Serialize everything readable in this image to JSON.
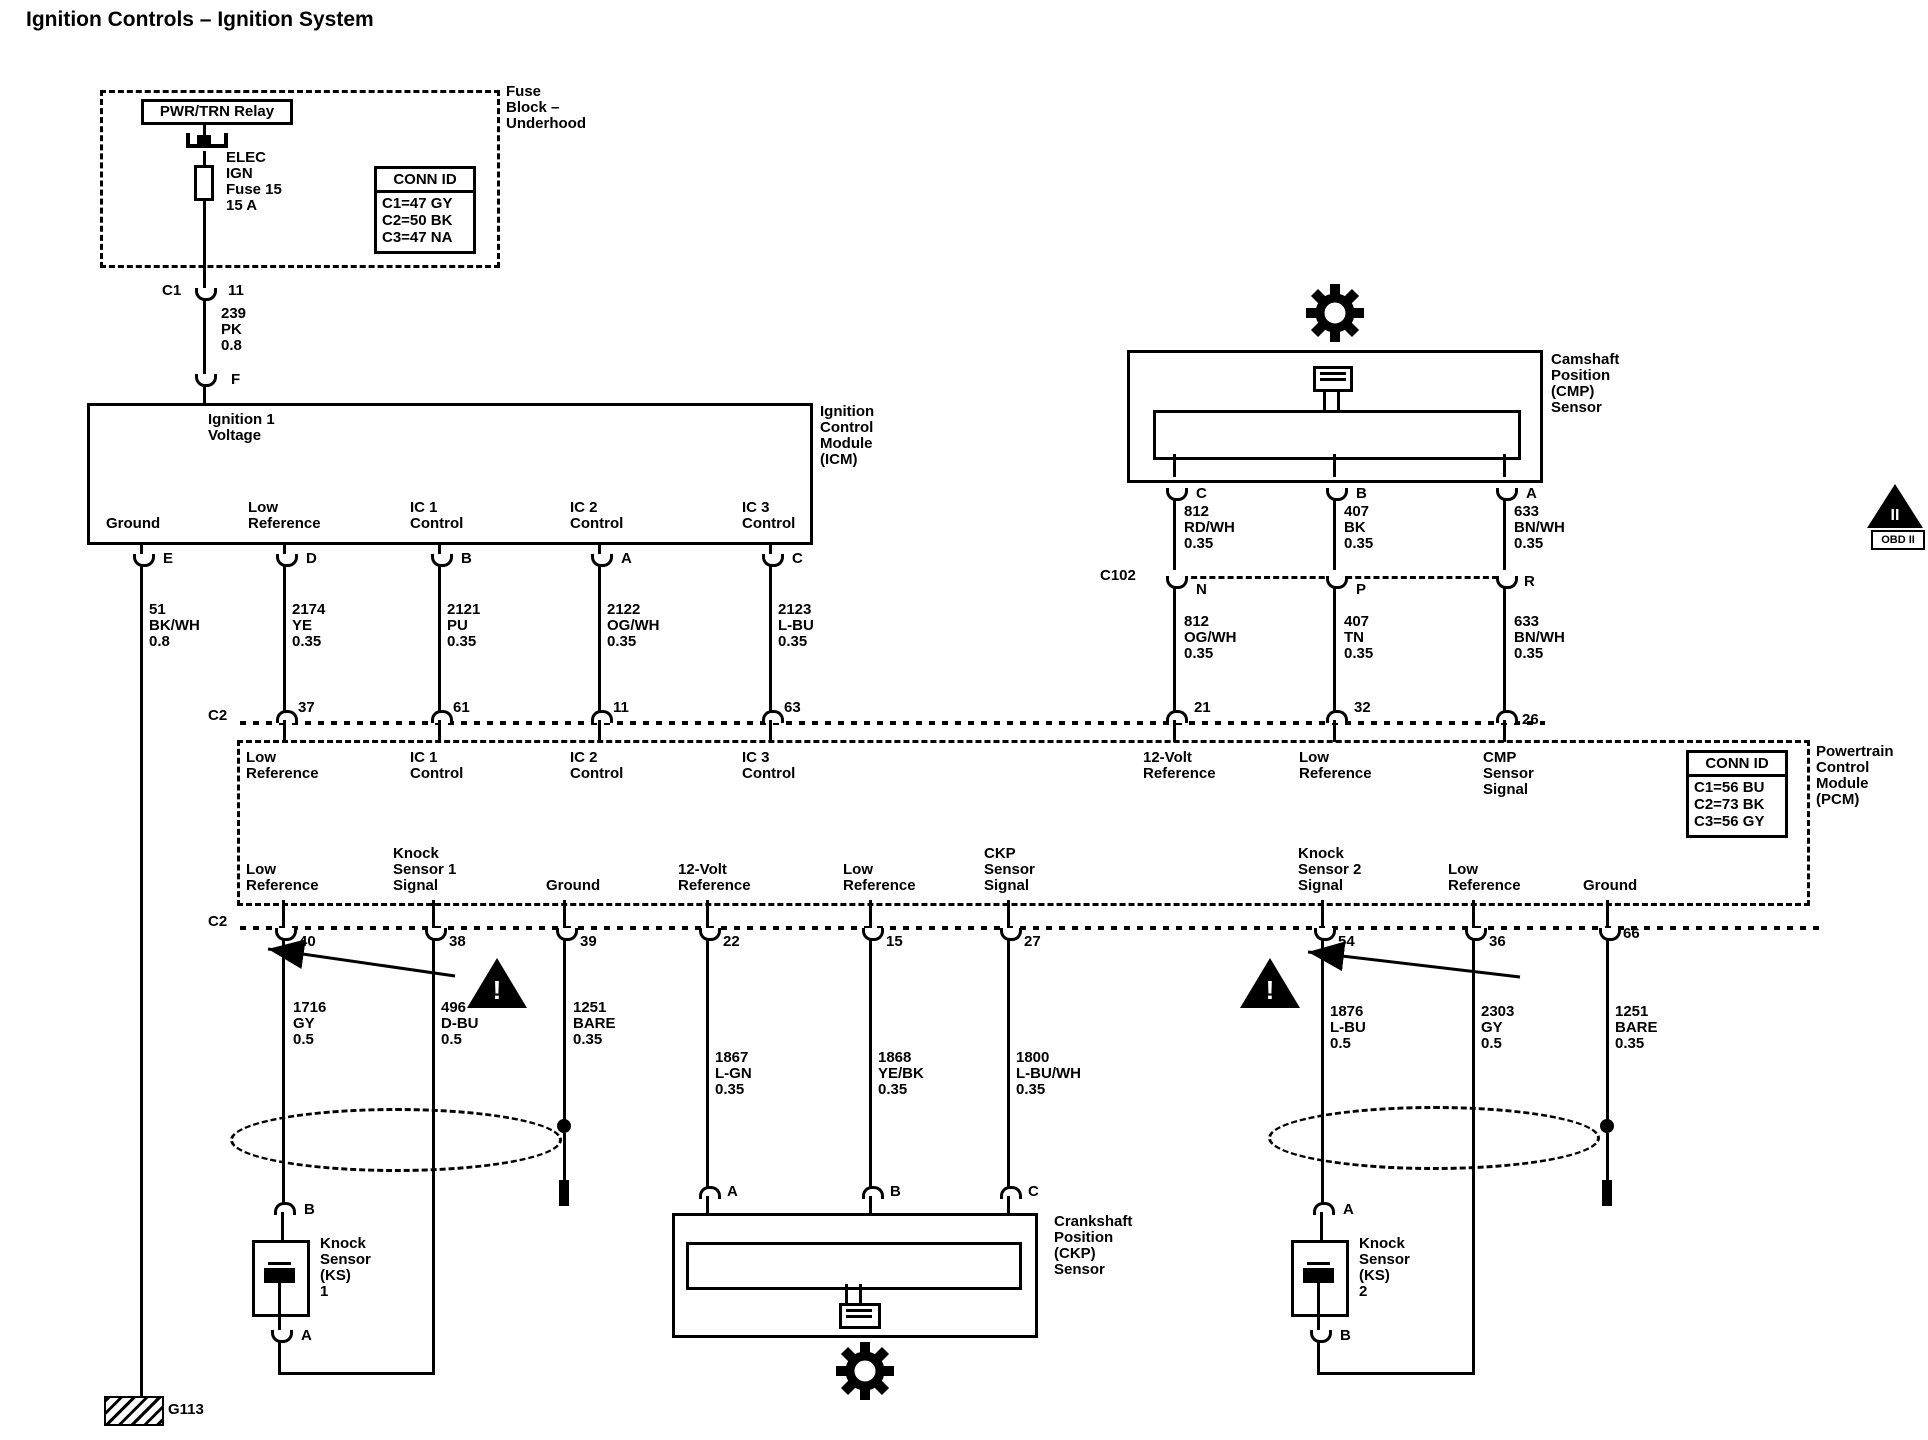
{
  "title": "Ignition Controls – Ignition System",
  "fuse_block": {
    "name": [
      "Fuse",
      "Block –",
      "Underhood"
    ],
    "relay_label": "PWR/TRN Relay",
    "fuse_label": [
      "ELEC",
      "IGN",
      "Fuse 15",
      "15 A"
    ],
    "conn_id": {
      "title": "CONN ID",
      "rows": [
        "C1=47 GY",
        "C2=50 BK",
        "C3=47 NA"
      ]
    },
    "connector": {
      "name": "C1",
      "pin": "11"
    },
    "wire": [
      "239",
      "PK",
      "0.8"
    ],
    "icm_pin": "F"
  },
  "icm": {
    "input_label": [
      "Ignition 1",
      "Voltage"
    ],
    "name": [
      "Ignition",
      "Control",
      "Module",
      "(ICM)"
    ],
    "functions": [
      [
        "Ground"
      ],
      [
        "Low",
        "Reference"
      ],
      [
        "IC 1",
        "Control"
      ],
      [
        "IC 2",
        "Control"
      ],
      [
        "IC 3",
        "Control"
      ]
    ],
    "pins": [
      "E",
      "D",
      "B",
      "A",
      "C"
    ],
    "wires": [
      [
        "51",
        "BK/WH",
        "0.8"
      ],
      [
        "2174",
        "YE",
        "0.35"
      ],
      [
        "2121",
        "PU",
        "0.35"
      ],
      [
        "2122",
        "OG/WH",
        "0.35"
      ],
      [
        "2123",
        "L-BU",
        "0.35"
      ]
    ]
  },
  "pcm": {
    "name": [
      "Powertrain",
      "Control",
      "Module",
      "(PCM)"
    ],
    "conn_id": {
      "title": "CONN ID",
      "rows": [
        "C1=56 BU",
        "C2=73 BK",
        "C3=56 GY"
      ]
    },
    "top_connector": "C2",
    "top_pins": [
      "37",
      "61",
      "11",
      "63",
      "21",
      "32",
      "26"
    ],
    "top_functions": [
      [
        "Low",
        "Reference"
      ],
      [
        "IC 1",
        "Control"
      ],
      [
        "IC 2",
        "Control"
      ],
      [
        "IC 3",
        "Control"
      ],
      [
        "12-Volt",
        "Reference"
      ],
      [
        "Low",
        "Reference"
      ],
      [
        "CMP",
        "Sensor",
        "Signal"
      ]
    ],
    "bottom_connector": "C2",
    "bottom_pins": [
      "40",
      "38",
      "39",
      "22",
      "15",
      "27",
      "54",
      "36",
      "66"
    ],
    "bottom_functions": [
      [
        "Low",
        "Reference"
      ],
      [
        "Knock",
        "Sensor 1",
        "Signal"
      ],
      [
        "Ground"
      ],
      [
        "12-Volt",
        "Reference"
      ],
      [
        "Low",
        "Reference"
      ],
      [
        "CKP",
        "Sensor",
        "Signal"
      ],
      [
        "Knock",
        "Sensor 2",
        "Signal"
      ],
      [
        "Low",
        "Reference"
      ],
      [
        "Ground"
      ]
    ]
  },
  "cmp_sensor": {
    "name": [
      "Camshaft",
      "Position",
      "(CMP)",
      "Sensor"
    ],
    "pins": [
      "C",
      "B",
      "A"
    ],
    "wires_upper": [
      [
        "812",
        "RD/WH",
        "0.35"
      ],
      [
        "407",
        "BK",
        "0.35"
      ],
      [
        "633",
        "BN/WH",
        "0.35"
      ]
    ],
    "connector": {
      "name": "C102",
      "pins": [
        "N",
        "P",
        "R"
      ]
    },
    "wires_lower": [
      [
        "812",
        "OG/WH",
        "0.35"
      ],
      [
        "407",
        "TN",
        "0.35"
      ],
      [
        "633",
        "BN/WH",
        "0.35"
      ]
    ]
  },
  "ckp_sensor": {
    "name": [
      "Crankshaft",
      "Position",
      "(CKP)",
      "Sensor"
    ],
    "pins": [
      "A",
      "B",
      "C"
    ]
  },
  "knock_sensor_1": {
    "name": [
      "Knock",
      "Sensor",
      "(KS)",
      "1"
    ],
    "top_pin": "B",
    "bottom_pin": "A"
  },
  "knock_sensor_2": {
    "name": [
      "Knock",
      "Sensor",
      "(KS)",
      "2"
    ],
    "top_pin": "A",
    "bottom_pin": "B"
  },
  "harness_wires": [
    [
      "1716",
      "GY",
      "0.5"
    ],
    [
      "496",
      "D-BU",
      "0.5"
    ],
    [
      "1251",
      "BARE",
      "0.35"
    ],
    [
      "1867",
      "L-GN",
      "0.35"
    ],
    [
      "1868",
      "YE/BK",
      "0.35"
    ],
    [
      "1800",
      "L-BU/WH",
      "0.35"
    ],
    [
      "1876",
      "L-BU",
      "0.5"
    ],
    [
      "2303",
      "GY",
      "0.5"
    ],
    [
      "1251",
      "BARE",
      "0.35"
    ]
  ],
  "ground_point": "G113",
  "obd_marker": {
    "numeral": "II",
    "label": "OBD II"
  },
  "warning": "!",
  "colors": {
    "line": "#000000",
    "background": "#ffffff"
  }
}
